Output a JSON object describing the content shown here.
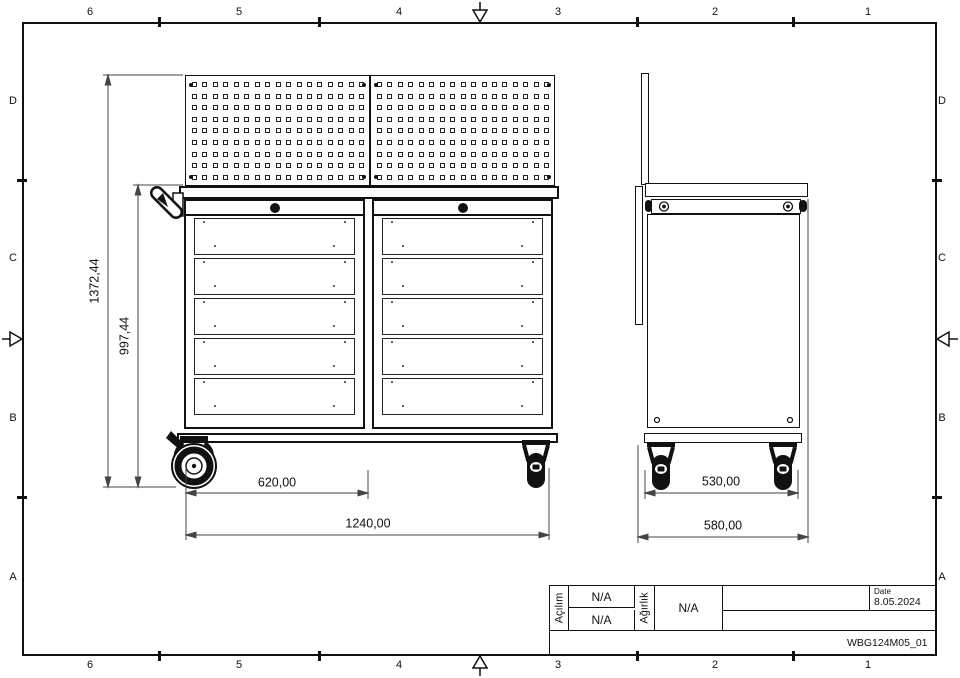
{
  "sheet": {
    "border_columns": [
      "6",
      "5",
      "4",
      "3",
      "2",
      "1"
    ],
    "border_rows": [
      "D",
      "C",
      "B",
      "A"
    ]
  },
  "title_block": {
    "fold_label": "Açılım",
    "fold_value_1": "N/A",
    "fold_value_2": "N/A",
    "weight_label": "Ağırlık",
    "weight_value": "N/A",
    "date_label": "Date",
    "date_value": "8.05.2024",
    "drawing_number": "WBG124M05_01"
  },
  "dimensions": {
    "front_total_height": "1372,44",
    "front_cabinet_height": "997,44",
    "front_half_width": "620,00",
    "front_total_width": "1240,00",
    "side_caster_span": "530,00",
    "side_total_depth": "580,00"
  },
  "structure": {
    "pegboard_panels": 2,
    "pegboard_hole_rows": 9,
    "pegboard_hole_cols": 17,
    "cabinets": 2,
    "drawers_per_cabinet": 5
  },
  "colors": {
    "line": "#111111",
    "background": "#ffffff"
  }
}
